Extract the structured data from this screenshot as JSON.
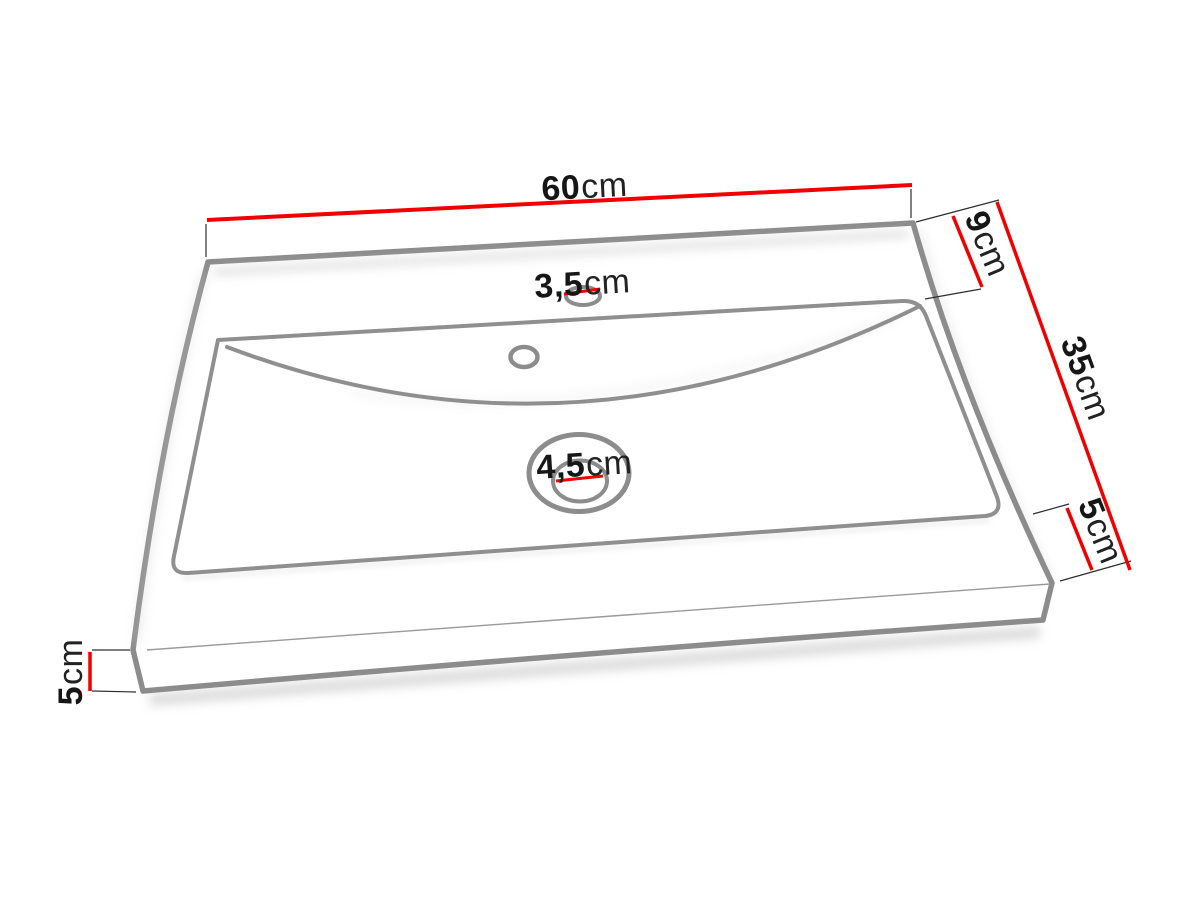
{
  "diagram": {
    "subject": "washbasin technical dimension drawing",
    "view": "perspective top-front view",
    "colors": {
      "dimension_line": "#f10000",
      "outline_gray": "#8c8c8c",
      "extension_line": "#2e2e2e",
      "label_text": "#161616",
      "background": "#ffffff"
    },
    "dimensions": {
      "top_width": {
        "value": "60",
        "unit": "cm"
      },
      "back_ledge_depth": {
        "value": "9",
        "unit": "cm"
      },
      "side_depth": {
        "value": "35",
        "unit": "cm"
      },
      "front_right_height": {
        "value": "5",
        "unit": "cm"
      },
      "left_edge_height": {
        "value": "5",
        "unit": "cm"
      },
      "tap_hole_diameter": {
        "value": "3,5",
        "unit": "cm"
      },
      "drain_hole_diameter": {
        "value": "4,5",
        "unit": "cm"
      }
    }
  }
}
